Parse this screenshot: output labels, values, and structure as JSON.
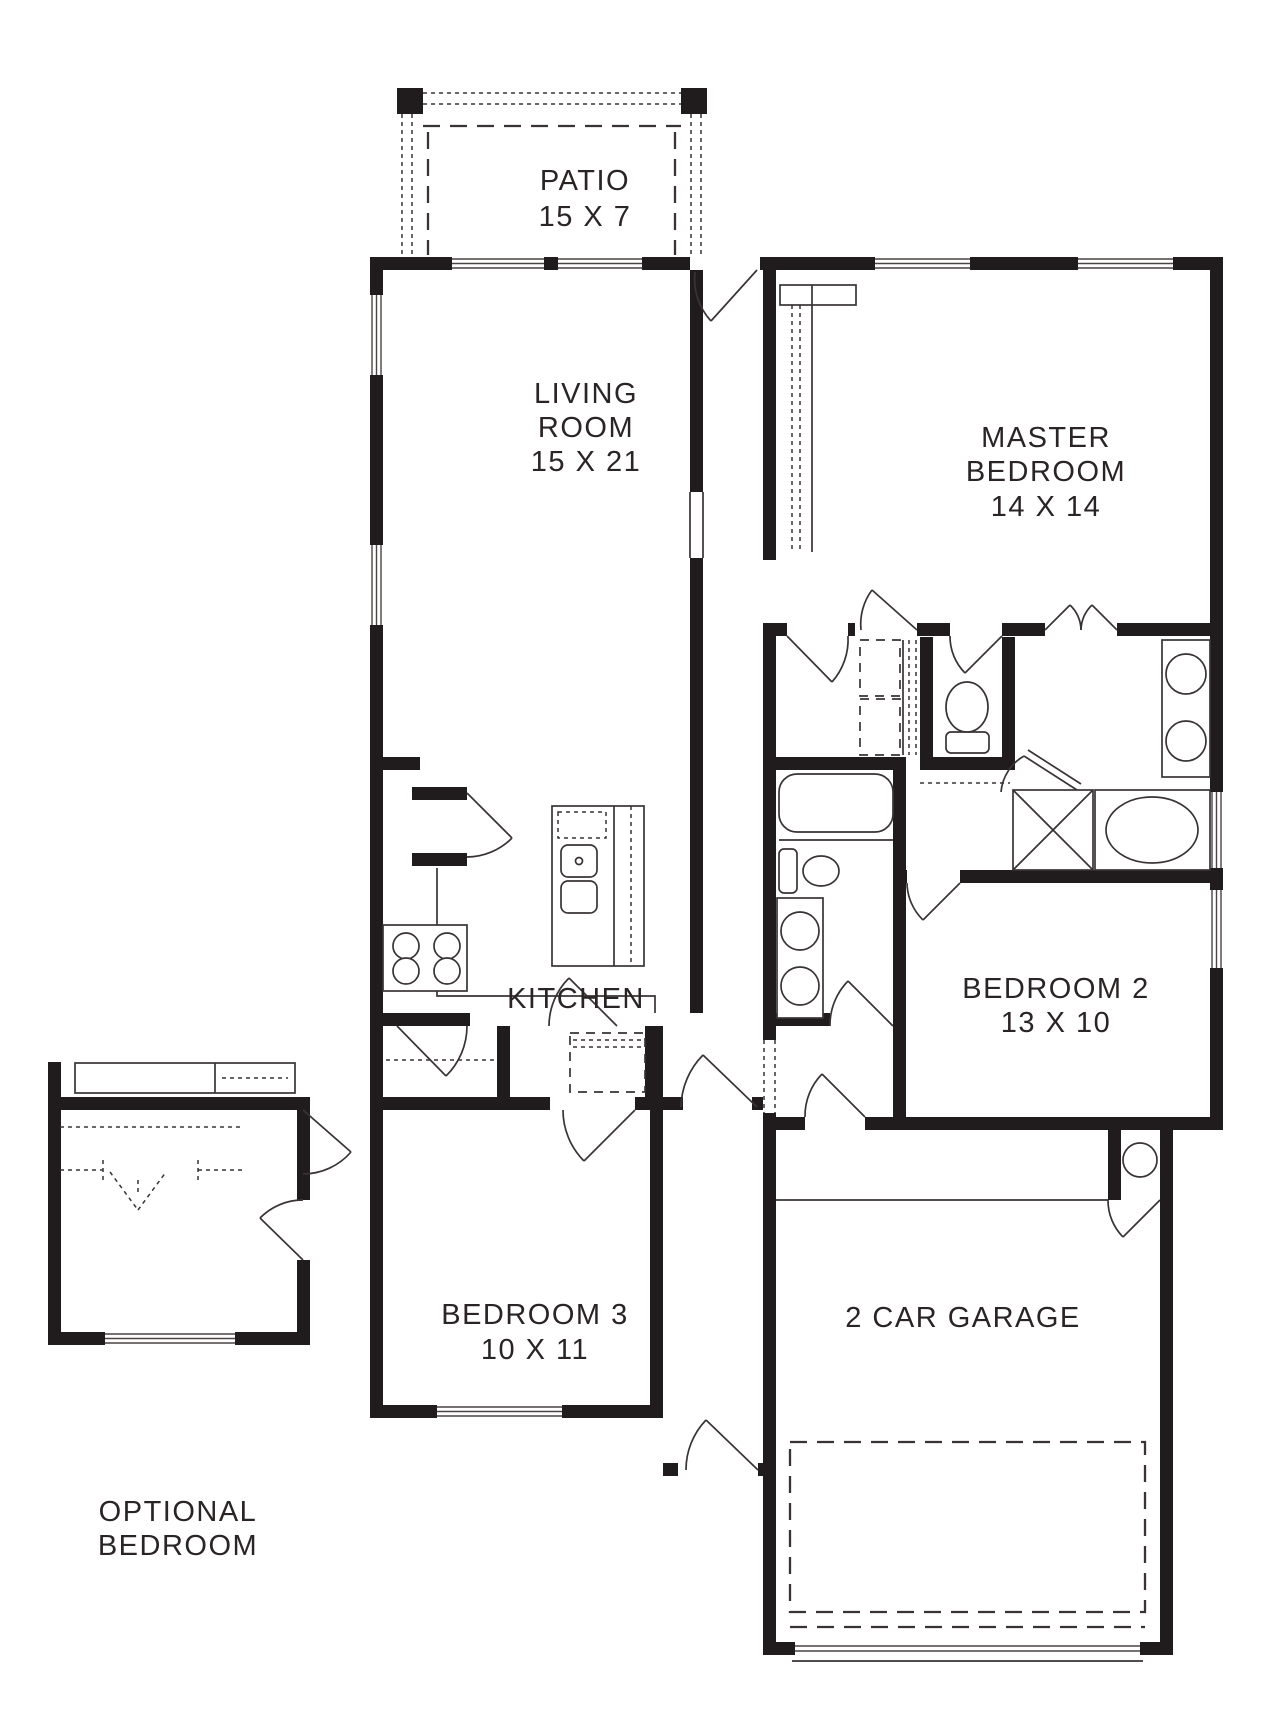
{
  "title": "Single-story house floor plan",
  "colors": {
    "wall": "#201c1d",
    "line": "#393334",
    "background": "#ffffff"
  },
  "rooms": {
    "patio": {
      "lines": [
        "PATIO",
        "15 X 7"
      ]
    },
    "living_room": {
      "lines": [
        "LIVING",
        "ROOM",
        "15 X 21"
      ]
    },
    "master_bedroom": {
      "lines": [
        "MASTER",
        "BEDROOM",
        "14 X 14"
      ]
    },
    "kitchen": {
      "lines": [
        "KITCHEN"
      ]
    },
    "bedroom2": {
      "lines": [
        "BEDROOM 2",
        "13 X 10"
      ]
    },
    "bedroom3": {
      "lines": [
        "BEDROOM 3",
        "10 X 11"
      ]
    },
    "garage": {
      "lines": [
        "2 CAR GARAGE"
      ]
    },
    "optional_bedroom": {
      "lines": [
        "OPTIONAL",
        "BEDROOM"
      ]
    }
  },
  "fixtures": [
    "garden-tub",
    "walk-in-shower",
    "double-vanity-master",
    "master-toilet",
    "walk-in-closet-shelves",
    "hall-tub",
    "hall-toilet",
    "hall-vanity",
    "kitchen-island-sink",
    "range-stove",
    "pantry",
    "washer-dryer-space",
    "water-heater",
    "garage-parking-area",
    "optional-closet-bifold"
  ]
}
